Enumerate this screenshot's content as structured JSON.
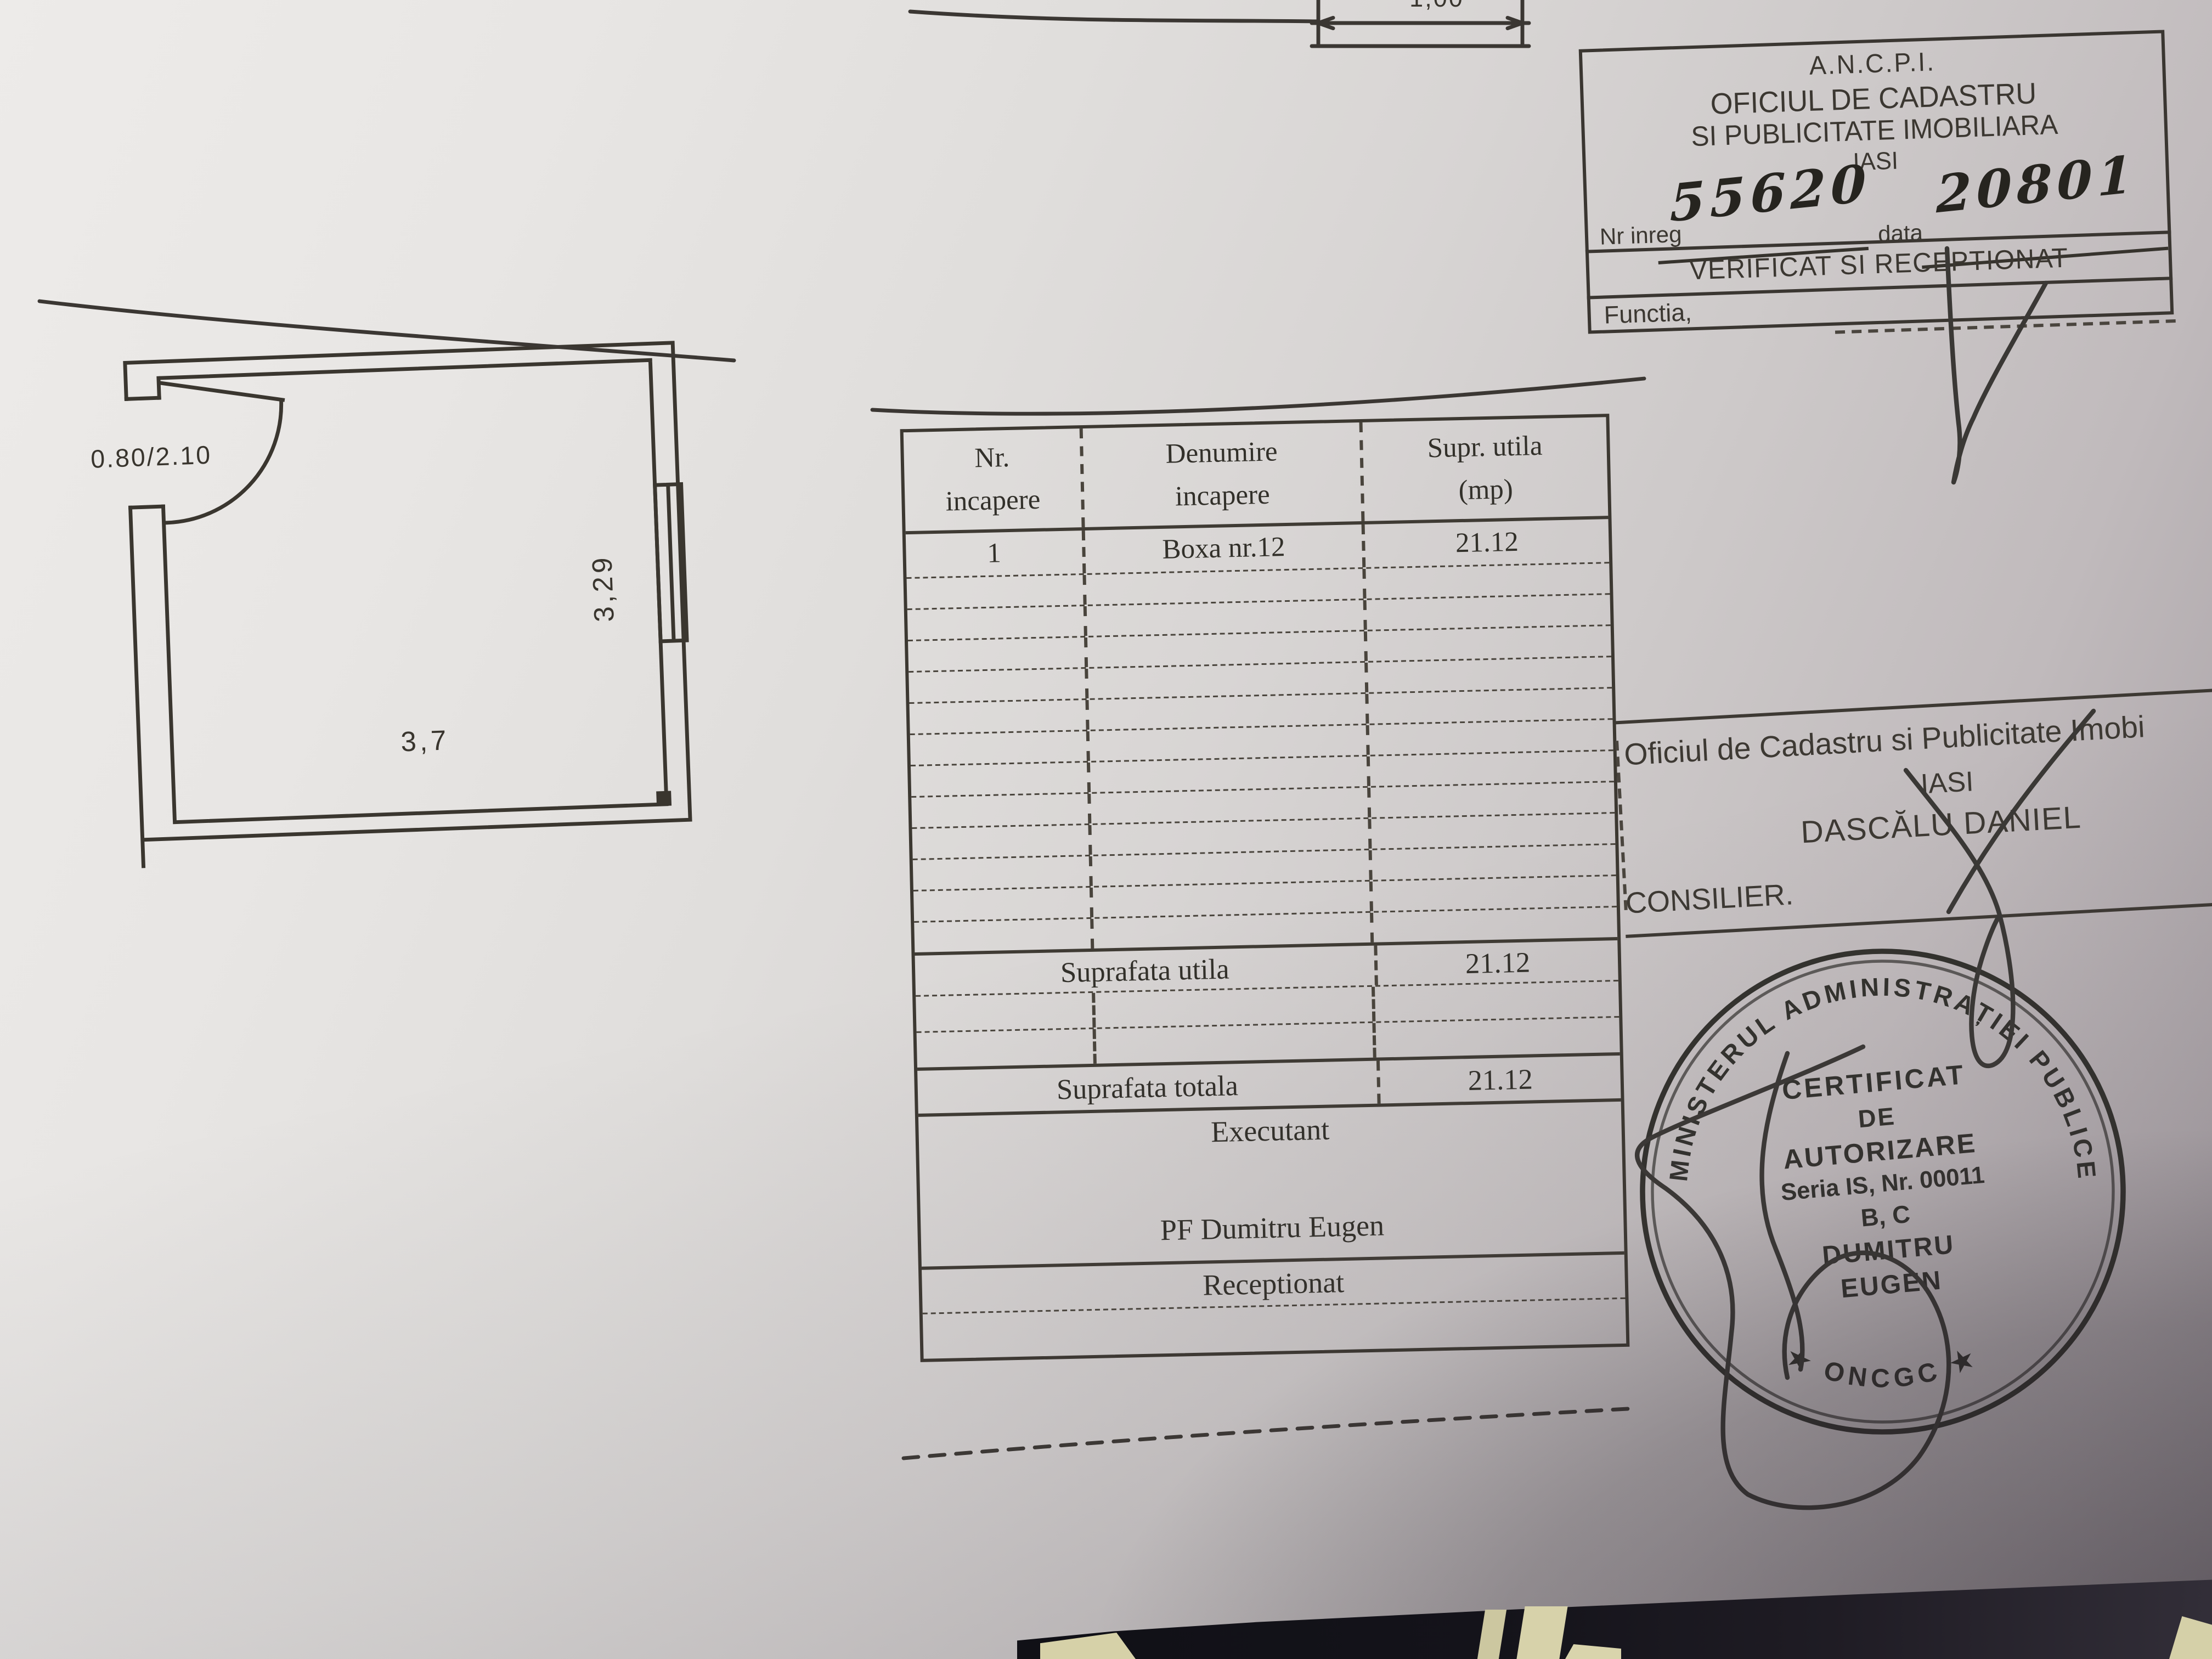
{
  "registration_box": {
    "agency": "A.N.C.P.I.",
    "office_line1": "OFICIUL DE CADASTRU",
    "office_line2": "SI PUBLICITATE IMOBILIARA",
    "city": "IASI",
    "reg_no_label": "Nr inreg",
    "reg_no_value": "55620",
    "date_label": "data",
    "date_value": "20801",
    "verified_line": "VERIFICAT SI RECEPTIONAT",
    "function_label": "Functia,"
  },
  "floor_plan": {
    "door_size_label": "0.80/2.10",
    "width_label": "3,7",
    "depth_label": "3,29",
    "top_fragment_label": "1,00"
  },
  "rooms_table": {
    "headers": [
      {
        "line1": "Nr.",
        "line2": "incapere"
      },
      {
        "line1": "Denumire",
        "line2": "incapere"
      },
      {
        "line1": "Supr. utila",
        "line2": "(mp)"
      }
    ],
    "rows": [
      {
        "nr": "1",
        "name": "Boxa nr.12",
        "area": "21.12"
      }
    ],
    "empty_rows_mid": 12,
    "useful_area_label": "Suprafata utila",
    "useful_area_value": "21.12",
    "total_area_label": "Suprafata totala",
    "total_area_value": "21.12",
    "executant_label": "Executant",
    "executant_name": "PF Dumitru Eugen",
    "receptionat_label": "Receptionat"
  },
  "office_stamp": {
    "line1": "Oficiul de Cadastru si Publicitate Imobi",
    "line2": "IASI",
    "line3": "DASCĂLU DANIEL",
    "line4": "CONSILIER."
  },
  "round_stamp": {
    "outer_text": "MINISTERUL ADMINISTRAȚIEI PUBLICE",
    "bottom_text": "★   ONCGC   ★",
    "center_lines": [
      "CERTIFICAT",
      "DE",
      "AUTORIZARE",
      "Seria IS, Nr. 00011",
      "B, C",
      "DUMITRU",
      "EUGEN"
    ]
  },
  "colors": {
    "ink": "#33302a",
    "stamp_ink": "#2b2a26",
    "paper_light": "#edebe9",
    "paper_shadow": "#999297",
    "desk_dark": "#14131a",
    "desk_beige": "#d6d1a8"
  }
}
